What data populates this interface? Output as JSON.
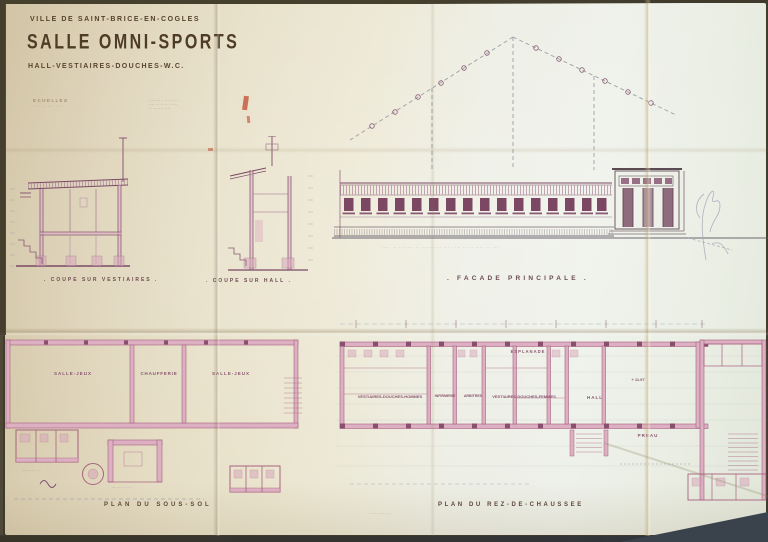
{
  "title_block": {
    "line1": "VILLE DE SAINT-BRICE-EN-COGLES",
    "line2": "SALLE OMNI-SPORTS",
    "line3": "HALL-VESTIAIRES-DOUCHES-W.C.",
    "scales_label": "ECHELLES",
    "scales_note": "··· ·· ··· ···",
    "stamp_line1": "········ · ·· ·······",
    "stamp_line2": "···· ·· ······ ·····",
    "stamp_line3": "·· ······· ····"
  },
  "captions": {
    "coupe_vestiaires": ". COUPE SUR VESTIAIRES .",
    "coupe_hall": ". COUPE SUR HALL .",
    "facade": ". FACADE PRINCIPALE .",
    "plan_sous_sol": "PLAN DU SOUS-SOL",
    "plan_rdc": "PLAN DU REZ-DE-CHAUSSEE"
  },
  "sous_sol": {
    "room1": "SALLE-JEUX",
    "room2": "CHAUFFERIE",
    "room3": "SALLE-JEUX",
    "note1": "····· ········ ···",
    "note2": "···· ····· ·· ····"
  },
  "rdc": {
    "esplanade": "ESPLANADE",
    "room1": "VESTIAIRES-DOUCHES-HOMMES",
    "room2": "INFIRMERIE",
    "room3": "ARBITRES",
    "room4": "VESTIAIRES-DOUCHES-FEMMES",
    "hall": "HALL",
    "preau": "PREAU",
    "level": "+ 11.97",
    "dims": "·· ··· ·· ···· ·· ···"
  },
  "facade_note": "···· ·· ······· ·· ········· ··· ···· ····· ···· ·· ···",
  "colors": {
    "ink": "#7a4a64",
    "wash": "#d9a8bc",
    "paper": "#e9e2cc",
    "pencil": "#9aa5a8"
  }
}
